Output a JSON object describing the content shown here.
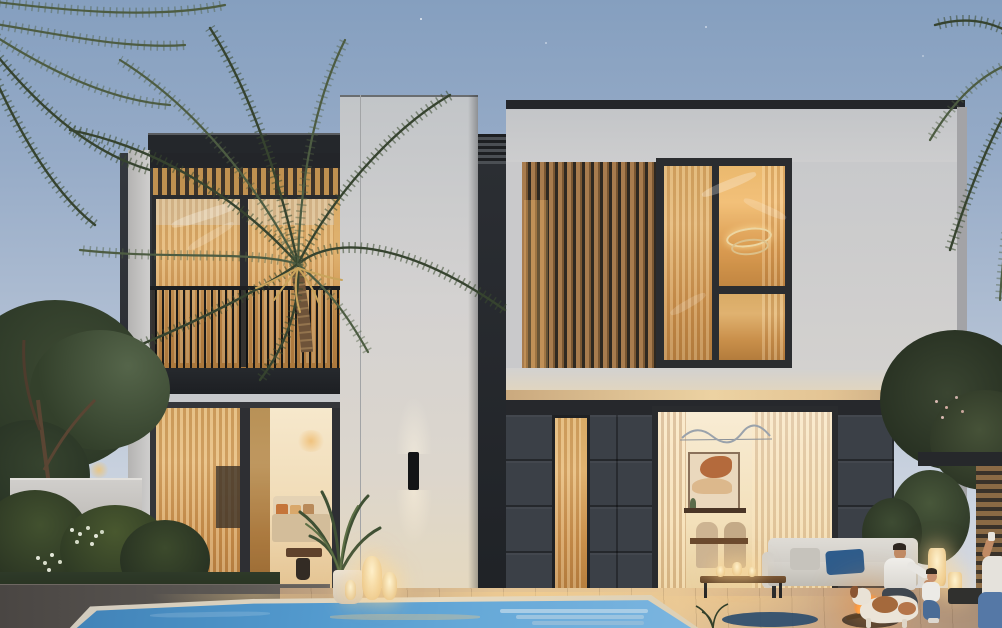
{
  "scene": {
    "label": "Photorealistic dusk rendering of a modern two-storey villa with pool, palms and a family by a fire pit",
    "time_of_day": "dusk",
    "people_visible": 3,
    "animals_visible": [
      "dog"
    ],
    "palette": {
      "sky_top": "#859fbf",
      "sky_horizon": "#d9dde5",
      "wall_white": "#d6d3d0",
      "wall_charcoal": "#2e3237",
      "wood_slat": "#a87c4e",
      "window_glow": "#e0b270",
      "stone_cladding": "#3b4047",
      "pool_water": "#4f93c9",
      "deck_warm": "#d9b386",
      "fire_glow": "#ff8c2a",
      "sofa_fabric": "#d9d6d0",
      "pillow_blue": "#2e5c8c",
      "foliage_dark": "#36432f"
    }
  },
  "objects": {
    "sky": {
      "label": "dusk sky with faint stars"
    },
    "palm_left": {
      "label": "tall date palm, left"
    },
    "palm_corner": {
      "label": "palm fronds entering top-left corner"
    },
    "palm_right": {
      "label": "palm fronds entering top-right corner"
    },
    "left_wing": {
      "label": "left wing with charcoal facade"
    },
    "balcony": {
      "label": "first-floor balcony with wood-slat pergola and slim railing"
    },
    "balcony_windows": {
      "label": "amber-lit balcony glazing"
    },
    "living_doors": {
      "label": "ground-floor sliding glass doors to living room"
    },
    "living_interior": {
      "label": "living room with beige sofa and orange cushions"
    },
    "center_tower": {
      "label": "central white stucco tower"
    },
    "wall_sconce": {
      "label": "up/down wall sconce"
    },
    "vent_louvers": {
      "label": "dark louver vent strip"
    },
    "right_wing": {
      "label": "right wing with white upper volume"
    },
    "slat_screen_upper": {
      "label": "vertical timber louver screen"
    },
    "upper_window": {
      "label": "double-height window with ring chandelier"
    },
    "stone_base": {
      "label": "dark stone clad ground floor"
    },
    "narrow_window": {
      "label": "slim lit window in stone wall"
    },
    "dining_doors": {
      "label": "glass doors to dining room with wall art"
    },
    "garden_wall": {
      "label": "low white garden wall"
    },
    "shrubs": {
      "label": "flowering shrubs and hedges"
    },
    "tree_left": {
      "label": "leafy tree, left garden"
    },
    "pergola_right": {
      "label": "dark pergola and timber screen, right"
    },
    "deck": {
      "label": "warm-lit timber pool deck"
    },
    "pool": {
      "label": "swimming pool with submerged steps"
    },
    "sofa": {
      "label": "white outdoor sofa with navy pillow"
    },
    "coffee_table": {
      "label": "outdoor coffee table with candles"
    },
    "rug": {
      "label": "round navy outdoor rug"
    },
    "potted_plant": {
      "label": "potted palm by the tower"
    },
    "lanterns": {
      "label": "glowing floor lanterns"
    },
    "fire_pit": {
      "label": "fire pit with flames"
    },
    "man": {
      "label": "man in white t-shirt petting the dog"
    },
    "child": {
      "label": "child in jeans beside the man"
    },
    "person_right": {
      "label": "person seated at far right"
    },
    "dog": {
      "label": "brown and white dog"
    }
  }
}
